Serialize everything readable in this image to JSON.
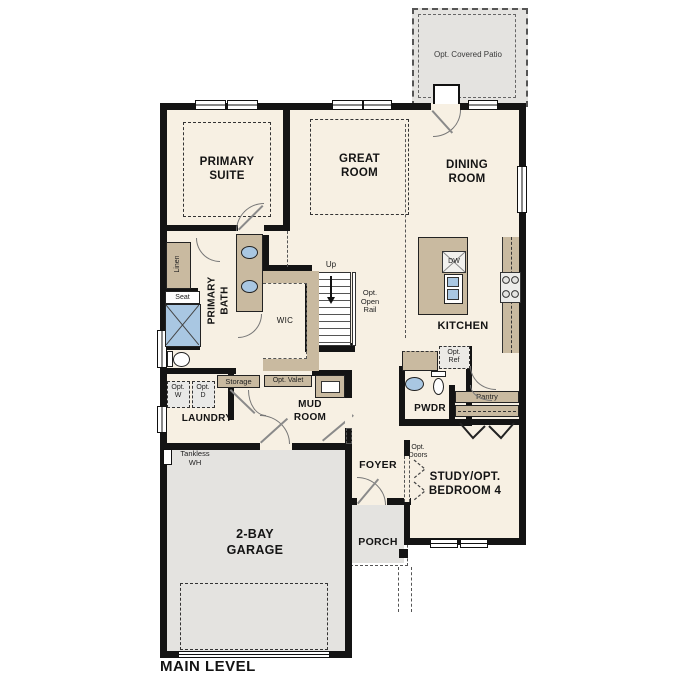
{
  "plan_title": "MAIN LEVEL",
  "rooms": {
    "patio": "Opt. Covered Patio",
    "primary_suite": "PRIMARY\nSUITE",
    "great_room": "GREAT\nROOM",
    "dining_room": "DINING\nROOM",
    "kitchen": "KITCHEN",
    "primary_bath": "PRIMARY\nBATH",
    "wic": "WIC",
    "laundry": "LAUNDRY",
    "mud_room": "MUD\nROOM",
    "pwdr": "PWDR",
    "pantry": "Pantry",
    "foyer": "FOYER",
    "study": "STUDY/OPT.\nBEDROOM 4",
    "porch": "PORCH",
    "garage": "2-BAY\nGARAGE"
  },
  "annotations": {
    "up": "Up",
    "opt_open_rail": "Opt.\nOpen\nRail",
    "dw": "DW",
    "opt_ref": "Opt.\nRef",
    "linen": "Linen",
    "seat": "Seat",
    "storage": "Storage",
    "opt_valet": "Opt. Valet",
    "opt_w": "Opt.\nW",
    "opt_d": "Opt.\nD",
    "tankless_wh": "Tankless\nWH",
    "opt_doors": "Opt.\nDoors"
  },
  "colors": {
    "floor": "#f7f0e3",
    "wall": "#141414",
    "cabinet": "#c9baa0",
    "exterior_gray": "#e4e3e0",
    "fixture_blue": "#a9c7e2"
  }
}
